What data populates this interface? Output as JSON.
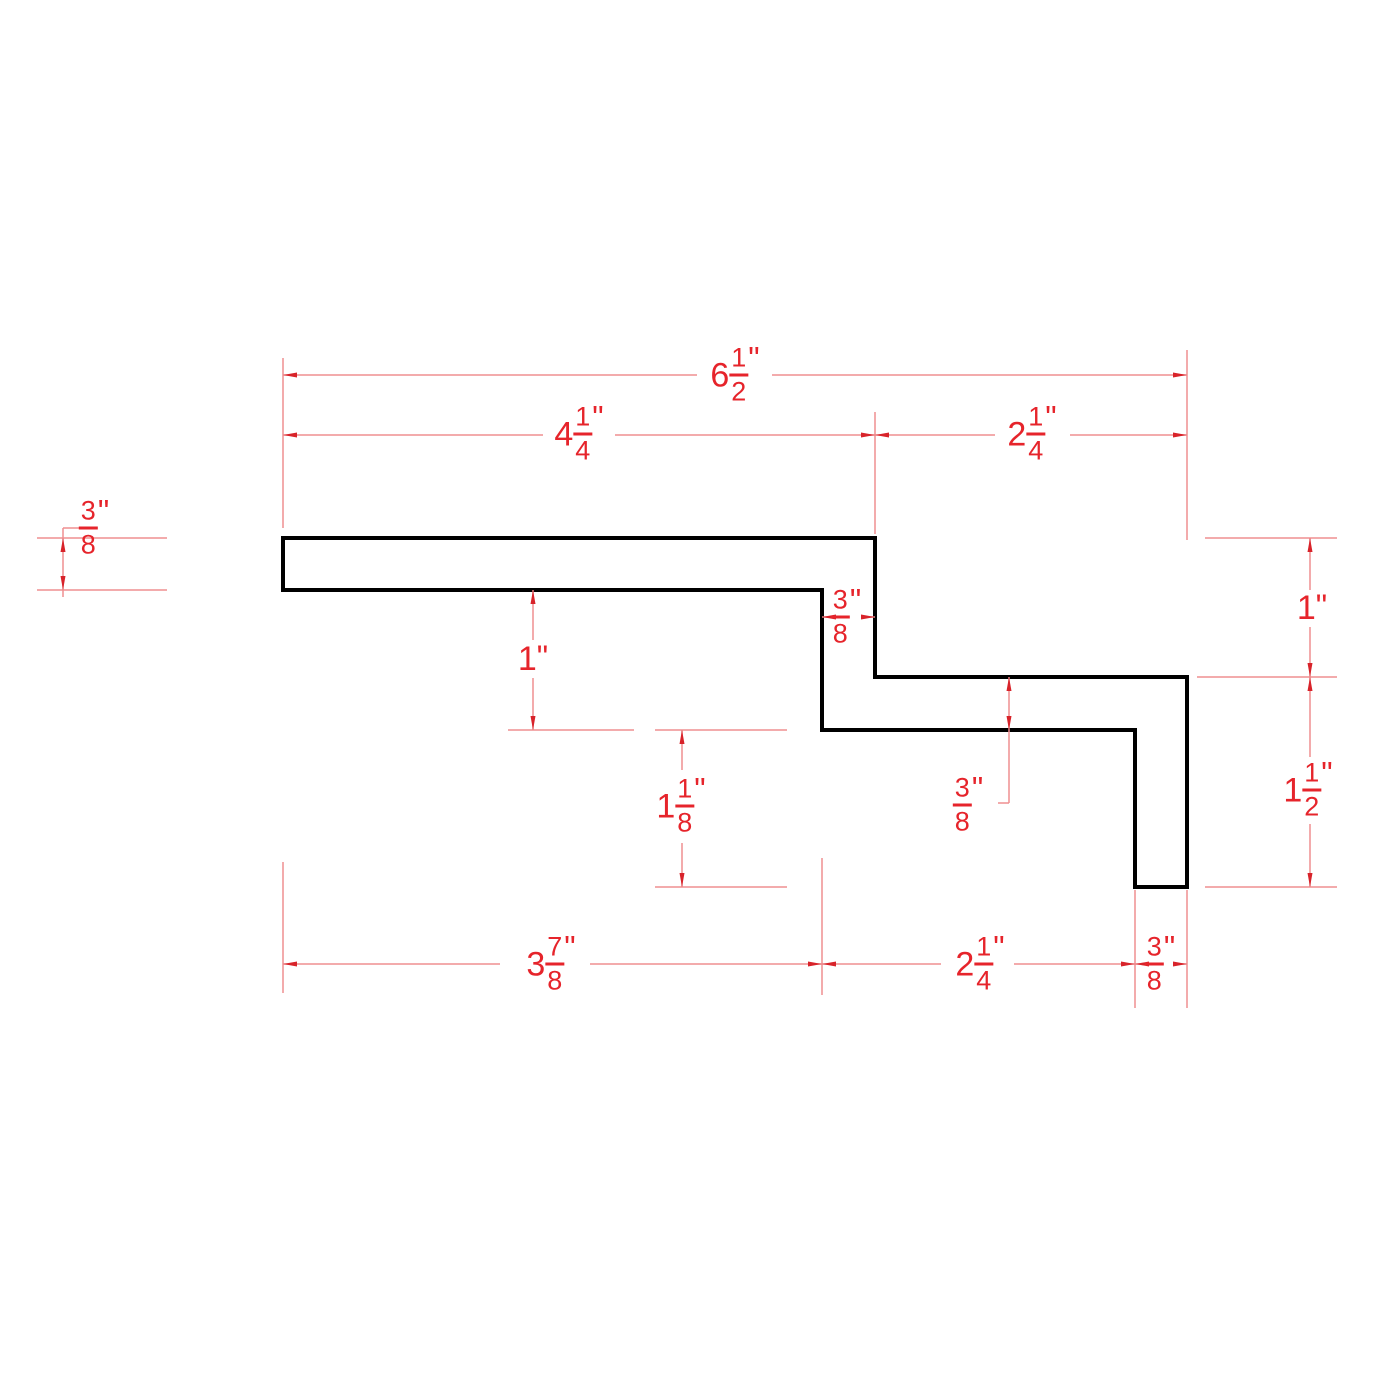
{
  "drawing": {
    "description": "2D CAD dimension drawing of a stepped Z-shaped sheet/trim profile cross-section",
    "units": "inches",
    "colors": {
      "background": "#ffffff",
      "profile_outline": "#000000",
      "dimension_line": "#ef8f91",
      "arrowhead": "#d8232a",
      "dimension_text": "#e6242b"
    }
  },
  "dims": {
    "top_overall": {
      "whole": "6",
      "num": "1",
      "den": "2",
      "unit": "\""
    },
    "top_left": {
      "whole": "4",
      "num": "1",
      "den": "4",
      "unit": "\""
    },
    "top_right": {
      "whole": "2",
      "num": "1",
      "den": "4",
      "unit": "\""
    },
    "left_thickness": {
      "num": "3",
      "den": "8",
      "unit": "\""
    },
    "step_thickness": {
      "num": "3",
      "den": "8",
      "unit": "\""
    },
    "mid_height": {
      "whole": "1",
      "unit": "\""
    },
    "mid_drop": {
      "whole": "1",
      "num": "1",
      "den": "8",
      "unit": "\""
    },
    "right_mid_thickness": {
      "num": "3",
      "den": "8",
      "unit": "\""
    },
    "right_upper": {
      "whole": "1",
      "unit": "\""
    },
    "right_lower": {
      "whole": "1",
      "num": "1",
      "den": "2",
      "unit": "\""
    },
    "bottom_left": {
      "whole": "3",
      "num": "7",
      "den": "8",
      "unit": "\""
    },
    "bottom_mid": {
      "whole": "2",
      "num": "1",
      "den": "4",
      "unit": "\""
    },
    "bottom_right": {
      "num": "3",
      "den": "8",
      "unit": "\""
    }
  }
}
